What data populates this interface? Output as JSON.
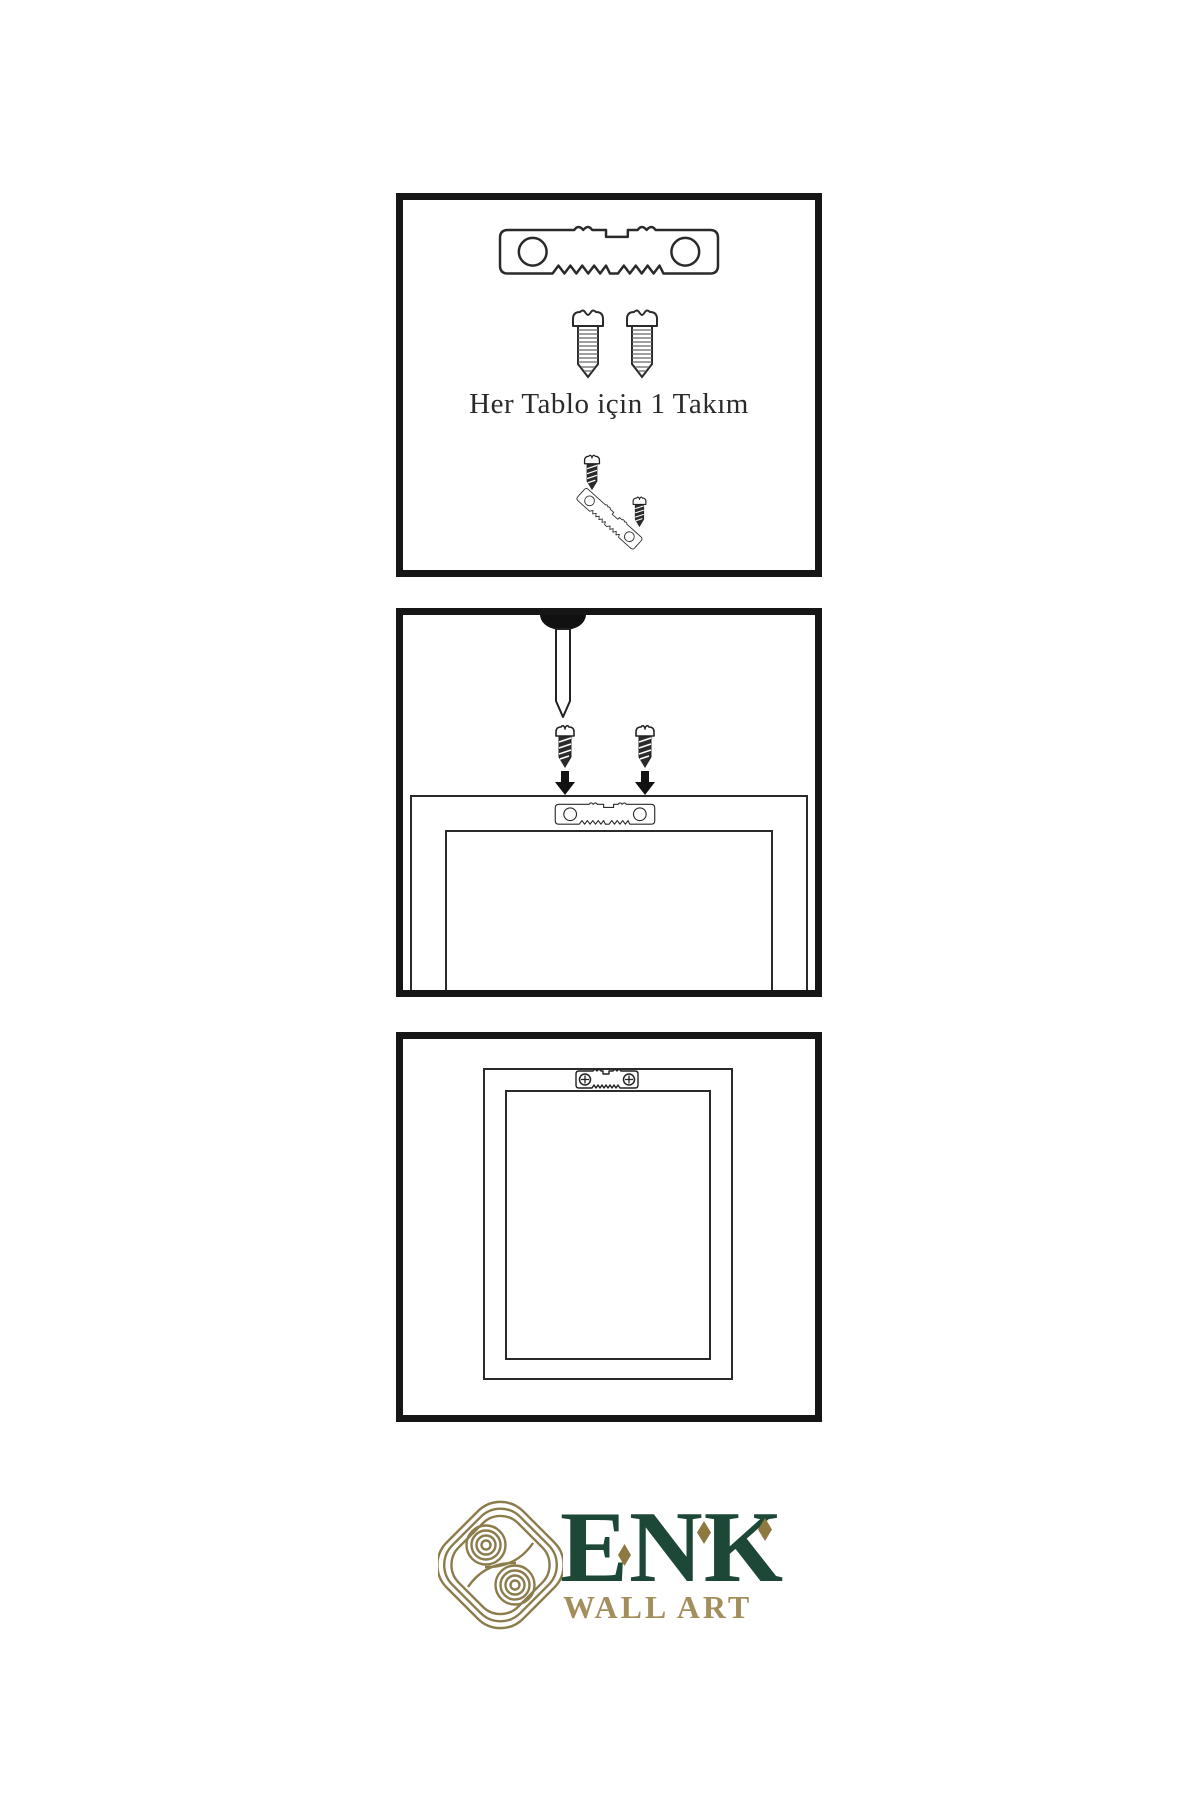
{
  "page": {
    "background": "#ffffff"
  },
  "steps": [
    {
      "id": 1,
      "caption": "Her Tablo için 1 Takım",
      "components": [
        "sawtooth-hanger",
        "screw",
        "screw",
        "screw-driven-into-angled-hanger"
      ]
    },
    {
      "id": 2,
      "caption": "",
      "components": [
        "wall-nail",
        "screw-with-down-arrow",
        "screw-with-down-arrow",
        "frame-back-with-sawtooth-hanger"
      ]
    },
    {
      "id": 3,
      "caption": "",
      "components": [
        "hung-frame-with-mounted-hanger"
      ]
    }
  ],
  "logo": {
    "brand": "ENK",
    "subtitle": "WALL ART",
    "mark": "interlaced-knot",
    "colors": {
      "brand_green": "#1d4837",
      "accent_gold": "#8e7940",
      "subtitle_tan": "#a38e5c",
      "knot_olive": "#8c7c4c"
    }
  },
  "colors": {
    "ink": "#161616",
    "line": "#2a2a2a",
    "background": "#ffffff"
  }
}
